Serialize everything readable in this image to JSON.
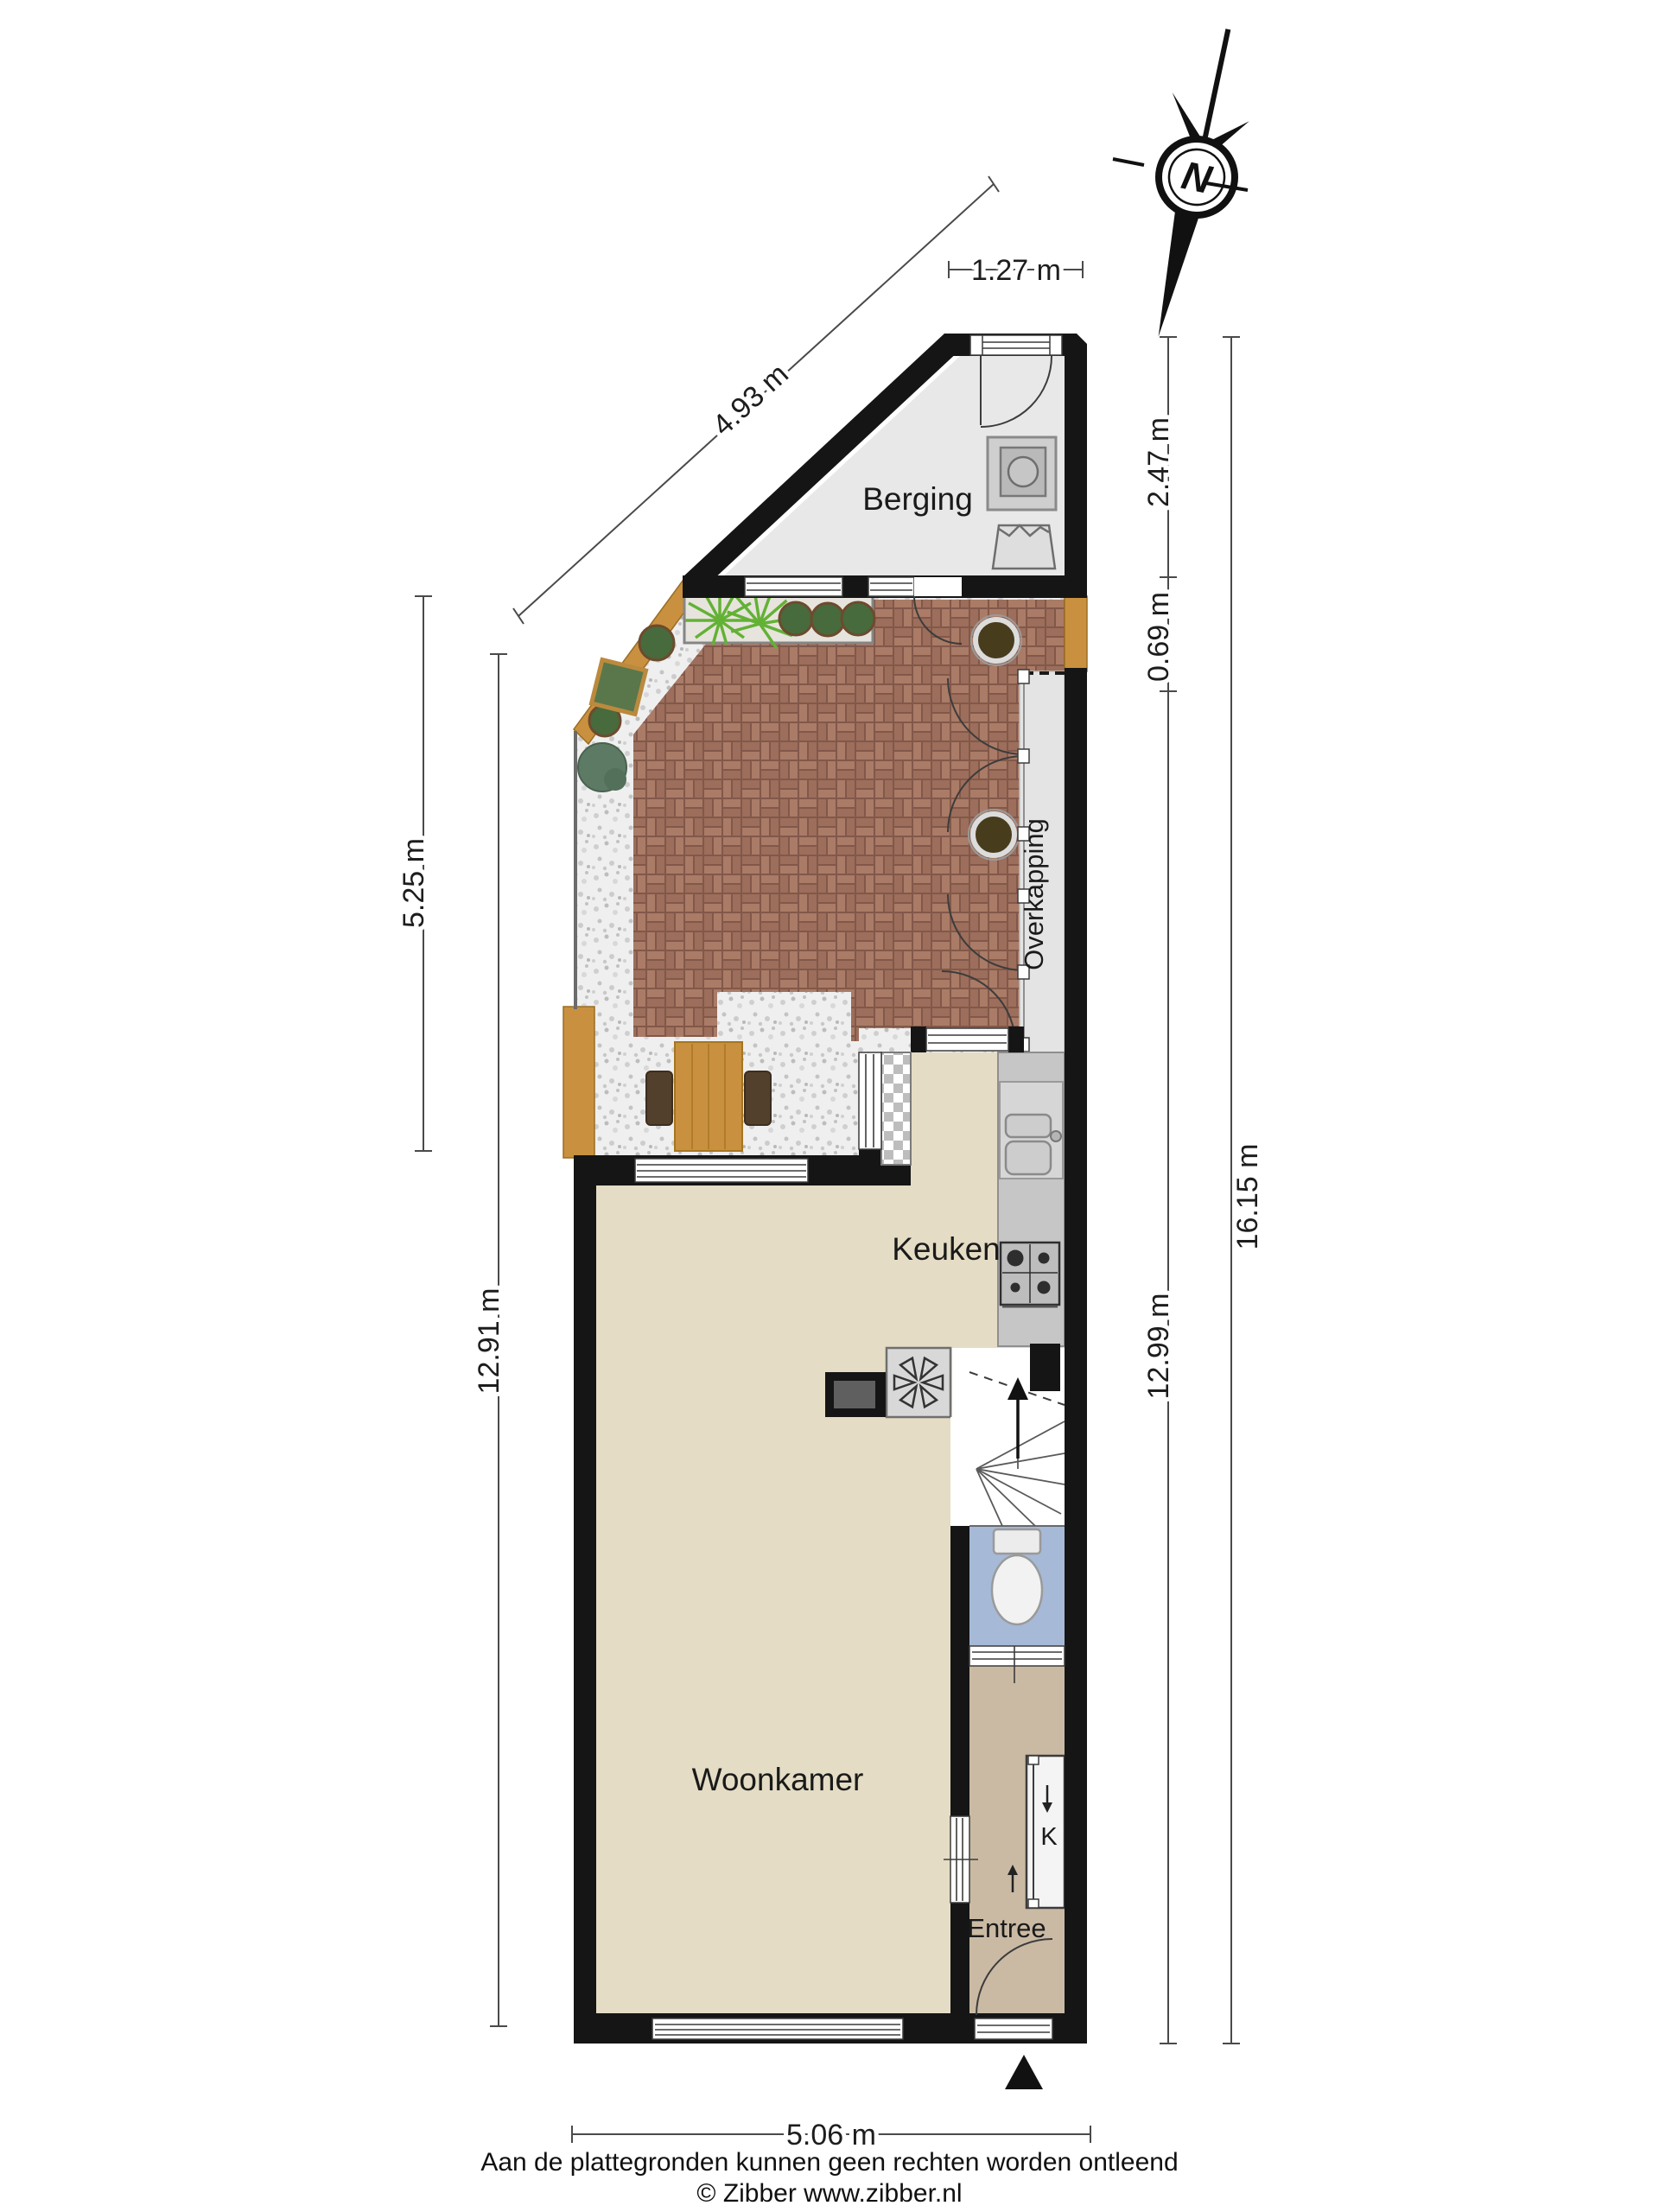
{
  "compass": {
    "letter": "N"
  },
  "rooms": {
    "berging": "Berging",
    "overkapping": "Overkapping",
    "keuken": "Keuken",
    "woonkamer": "Woonkamer",
    "entree": "Entree"
  },
  "labels": {
    "closet": "K"
  },
  "dimensions": {
    "berging_width": "1.27 m",
    "plot_diagonal": "4.93 m",
    "garden_left": "5.25 m",
    "house_left": "12.91 m",
    "berging_height": "2.47 m",
    "gap_right": "0.69 m",
    "house_right": "12.99 m",
    "total_right": "16.15 m",
    "house_width": "5.06 m"
  },
  "footer": {
    "disclaimer": "Aan de plattegronden kunnen geen rechten worden ontleend",
    "credit": "© Zibber www.zibber.nl"
  },
  "colors": {
    "wall": "#151515",
    "floor_living": "#e4dcc4",
    "floor_entree": "#cabaa4",
    "floor_toilet": "#a6b9d6",
    "floor_berging": "#e8e8e8",
    "floor_overkapping": "#e4e4e4",
    "brick_mortar": "#82584a",
    "brick_a": "#aa7b66",
    "brick_b": "#9c6e5b",
    "gravel_bg": "#efefef",
    "wood": "#c9913f",
    "counter": "#c6c6c6",
    "plant_dark": "#476b3c",
    "plant_bright": "#63b135"
  }
}
